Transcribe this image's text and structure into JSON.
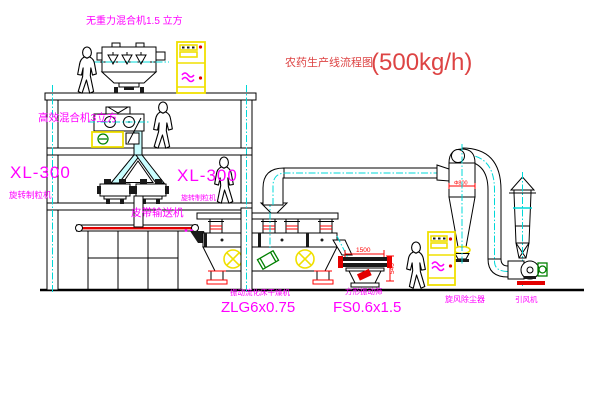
{
  "title": {
    "text": "农药生产线流程图",
    "capacity": "(500kg/h)"
  },
  "labels": {
    "gravity_free_mixer": "无重力混合机1.5 立方",
    "high_efficiency_mixer": "高效混合机3立方",
    "granulator_left_model": "XL-300",
    "granulator_left_name": "旋转制粒机",
    "granulator_right_model": "XL-300",
    "granulator_right_name": "旋转制粒机",
    "belt_conveyor": "皮带输送机",
    "dryer_name": "振动流化床干燥机",
    "dryer_model": "ZLG6x0.75",
    "screen_name": "方形振动筛",
    "screen_model": "FS0.6x1.5",
    "cyclone": "旋风除尘器",
    "fan": "引风机"
  },
  "dimensions": {
    "screen_length": "1500",
    "screen_height": "540",
    "cyclone_dim": "Φ800"
  },
  "colors": {
    "labels": "#ff00ff",
    "title": "#dd4444",
    "dimensions": "#ff0000",
    "centerlines": "#00d8d8",
    "cabinet": "#f0e000",
    "motor_green": "#008000",
    "outline": "#000000",
    "background": "#ffffff"
  }
}
